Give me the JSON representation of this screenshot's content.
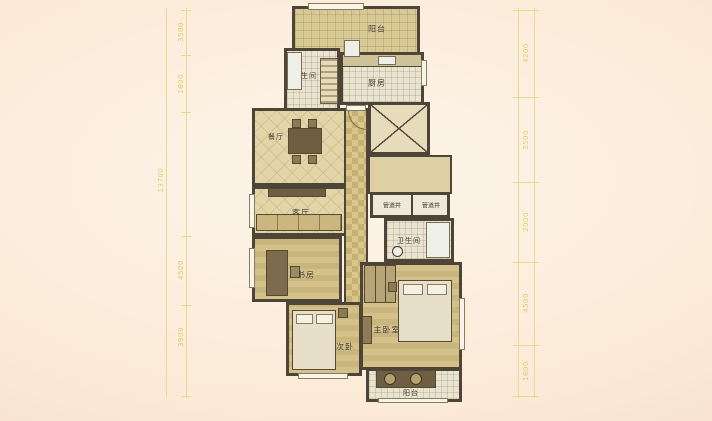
{
  "rooms": {
    "balcony_top": "阳台",
    "bathroom_top": "卫生间",
    "kitchen": "厨房",
    "dining": "餐厅",
    "living": "客厅",
    "pipe_shaft_left": "管道井",
    "pipe_shaft_right": "管道井",
    "bathroom_master": "卫生间",
    "study": "书房",
    "bedroom_secondary": "次卧",
    "bedroom_master": "主卧室",
    "balcony_bottom": "阳台"
  },
  "dimensions": {
    "left_outer": "13700",
    "left_inner": [
      "3500",
      "1800",
      "4500",
      "3900"
    ],
    "right": [
      "4200",
      "3500",
      "2000",
      "4500",
      "1800"
    ]
  },
  "colors": {
    "background_center": "#fdf5e9",
    "background_edge": "#f3d9c3",
    "wall": "#4e4539",
    "floor_tan": "#d9ca95",
    "floor_light": "#e9e3d0",
    "dimension_text": "#dccd6d",
    "label_text": "#3e362a"
  }
}
